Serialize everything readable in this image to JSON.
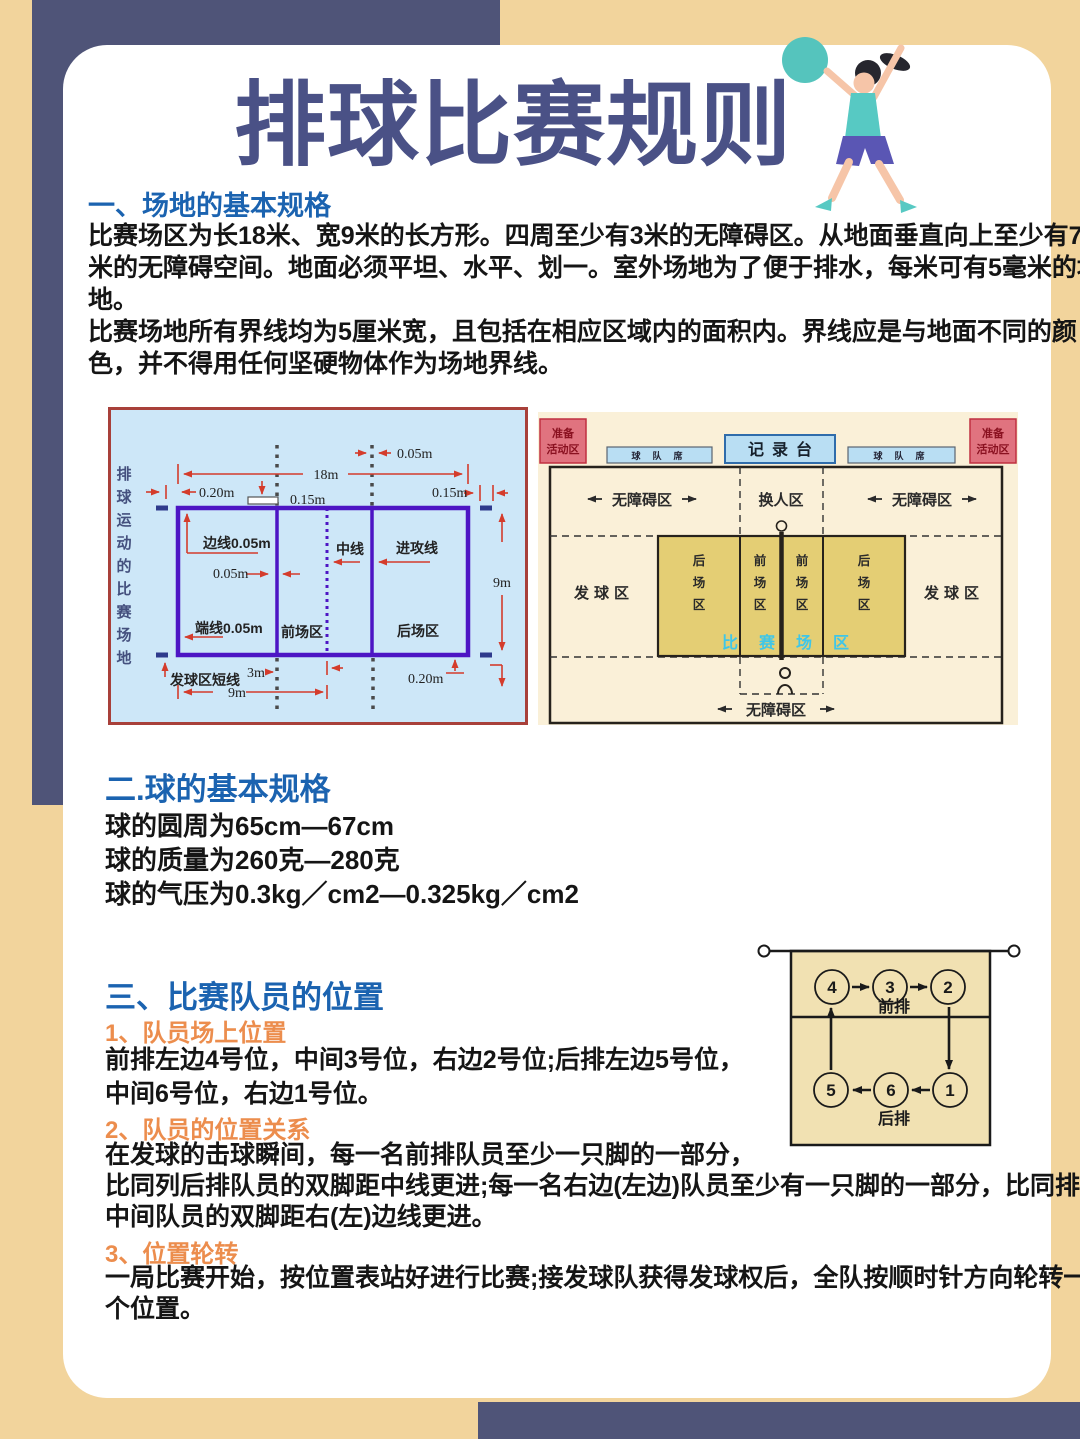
{
  "page_title": "排球比赛规则",
  "sections": {
    "s1": {
      "heading": "一、场地的基本规格",
      "lines": [
        "比赛场区为长18米、宽9米的长方形。四周至少有3米的无障碍区。从地面垂直向上至少有7",
        "米的无障碍空间。地面必须平坦、水平、划一。室外场地为了便于排水，每米可有5毫米的坡",
        "地。",
        "比赛场地所有界线均为5厘米宽，且包括在相应区域内的面积内。界线应是与地面不同的颜",
        "色，并不得用任何坚硬物体作为场地界线。"
      ]
    },
    "s2": {
      "heading": "二.球的基本规格",
      "lines": [
        "球的圆周为65cm—67cm",
        "球的质量为260克—280克",
        "球的气压为0.3kg／cm2—0.325kg／cm2"
      ]
    },
    "s3": {
      "heading": "三、比赛队员的位置",
      "sub1_heading": "1、队员场上位置",
      "sub1_lines": [
        "前排左边4号位，中间3号位，右边2号位;后排左边5号位，",
        "中间6号位，右边1号位。"
      ],
      "sub2_heading": "2、队员的位置关系",
      "sub2_lines": [
        "在发球的击球瞬间，每一名前排队员至少一只脚的一部分，",
        "比同列后排队员的双脚距中线更进;每一名右边(左边)队员至少有一只脚的一部分，比同排",
        "中间队员的双脚距右(左)边线更进。"
      ],
      "sub3_heading": "3、位置轮转",
      "sub3_lines": [
        "一局比赛开始，按位置表站好进行比赛;接发球队获得发球权后，全队按顺时针方向轮转一",
        "个位置。"
      ]
    }
  },
  "court_diagram": {
    "side_text_chars": [
      "排",
      "球",
      "运",
      "动",
      "的",
      "比",
      "赛",
      "场",
      "地"
    ],
    "dim_18m": "18m",
    "dim_005_top": "0.05m",
    "dim_020_top": "0.20m",
    "dim_015_mid": "0.15m",
    "dim_015_right": "0.15m",
    "side_line_label": "边线0.05m",
    "dim_005_mid": "0.05m",
    "center_line_label": "中线",
    "attack_line_label": "进攻线",
    "dim_9m_right": "9m",
    "end_line_label": "端线0.05m",
    "front_zone_label": "前场区",
    "back_zone_label": "后场区",
    "serve_short_label": "发球区短线",
    "dim_3m": "3m",
    "dim_9m_bottom": "9m",
    "dim_020_bottom": "0.20m"
  },
  "zone_diagram": {
    "warmup_lines": [
      "准备",
      "活动区"
    ],
    "recorder": "记录台",
    "bench": "球队席",
    "free_zone": "无障碍区",
    "sub_zone": "换人区",
    "serve_zone": "发球区",
    "back_zone_chars": [
      "后",
      "场",
      "区"
    ],
    "front_zone_chars": [
      "前",
      "场",
      "区"
    ],
    "play_zone_chars": [
      "比",
      "赛",
      "场",
      "区"
    ]
  },
  "rotation_diagram": {
    "front_label": "前排",
    "back_label": "后排",
    "front_row": [
      "4",
      "3",
      "2"
    ],
    "back_row": [
      "5",
      "6",
      "1"
    ]
  },
  "colors": {
    "page_tan": "#f2d49c",
    "navy": "#4f5478",
    "title_indigo": "#4a5186",
    "heading_blue": "#1b63b0",
    "subheading_orange": "#ec8d4d",
    "court_panel_blue": "#cde7f8",
    "court_line_purple": "#4d15c4",
    "dim_red": "#d43c2c",
    "zone_panel_cream": "#faf0d8",
    "zone_court_yellow": "#e4ce74",
    "play_zone_cyan": "#3fc6e8",
    "warmup_pink": "#e0737f",
    "bench_blue": "#b9def3",
    "rotation_tan": "#f1e1b2"
  }
}
